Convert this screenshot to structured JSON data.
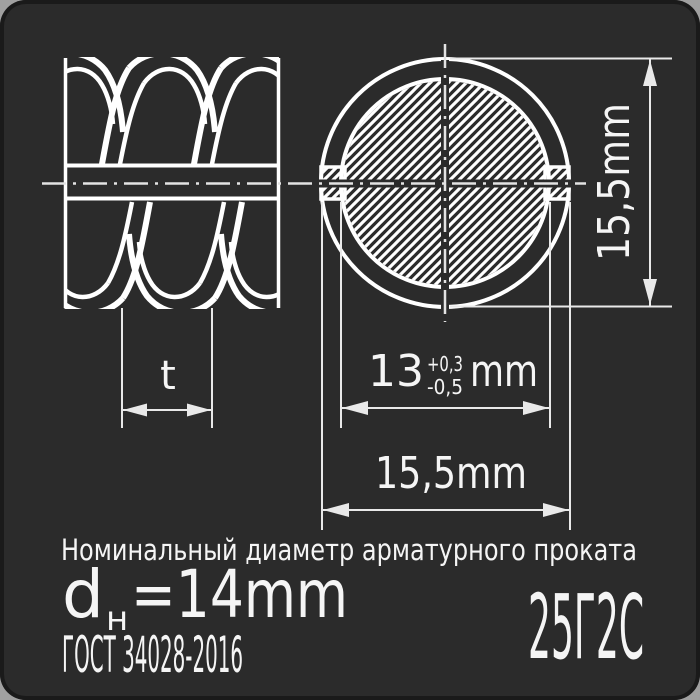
{
  "colors": {
    "canvas_bg": "#2b2b2b",
    "line": "#ffffff",
    "dim_line": "#e9e9e9",
    "text": "#f5f5f5",
    "page_bg": "#a0a0a0"
  },
  "drawing": {
    "side_view": {
      "pitch_label": "t"
    },
    "cross_section": {
      "core_diameter_value": "13",
      "core_tolerance_plus": "+0,3",
      "core_tolerance_minus": "-0,5",
      "core_unit": "mm",
      "overall_width": "15,5mm",
      "overall_height": "15,5mm"
    }
  },
  "caption": {
    "title": "Номинальный диаметр арматурного проката",
    "diameter_symbol": "d",
    "diameter_index": "н",
    "diameter_value": "=14mm",
    "standard": "ГОСТ 34028-2016",
    "steel_grade": "25Г2С"
  }
}
